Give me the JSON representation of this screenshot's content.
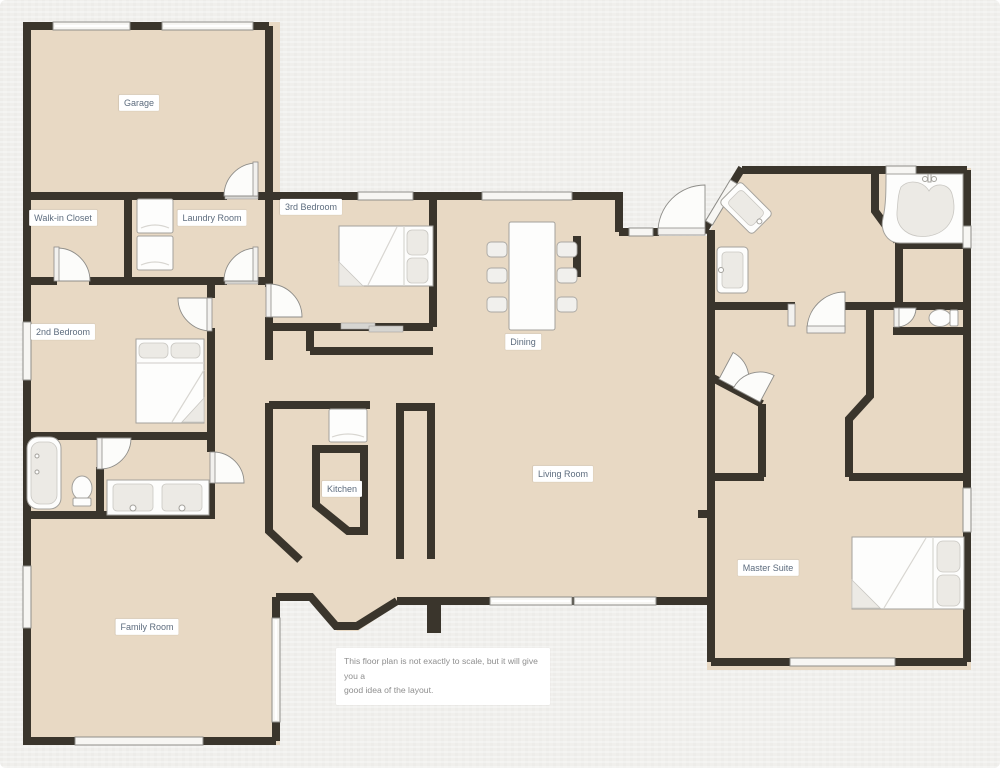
{
  "title": "House floor plan",
  "rooms": [
    {
      "id": "garage",
      "label": "Garage",
      "x": 139,
      "y": 103
    },
    {
      "id": "walk-in-closet",
      "label": "Walk-in Closet",
      "x": 63,
      "y": 218
    },
    {
      "id": "laundry-room",
      "label": "Laundry Room",
      "x": 212,
      "y": 218
    },
    {
      "id": "3rd-bedroom",
      "label": "3rd Bedroom",
      "x": 311,
      "y": 207
    },
    {
      "id": "2nd-bedroom",
      "label": "2nd Bedroom",
      "x": 63,
      "y": 332
    },
    {
      "id": "dining",
      "label": "Dining",
      "x": 523,
      "y": 342
    },
    {
      "id": "kitchen",
      "label": "Kitchen",
      "x": 342,
      "y": 489
    },
    {
      "id": "living-room",
      "label": "Living Room",
      "x": 563,
      "y": 474
    },
    {
      "id": "family-room",
      "label": "Family Room",
      "x": 147,
      "y": 627
    },
    {
      "id": "master-suite",
      "label": "Master Suite",
      "x": 768,
      "y": 568
    }
  ],
  "disclaimer": {
    "line1": "This floor plan is not exactly to scale, but it will give you a",
    "line2": "good idea of the layout."
  },
  "fixtures": [
    {
      "id": "bed-2nd-bedroom",
      "type": "double-bed"
    },
    {
      "id": "bed-3rd-bedroom",
      "type": "double-bed"
    },
    {
      "id": "bed-master",
      "type": "double-bed"
    },
    {
      "id": "bathtub",
      "type": "bathtub"
    },
    {
      "id": "corner-tub",
      "type": "corner-garden-tub"
    },
    {
      "id": "toilet-hall-bath",
      "type": "toilet"
    },
    {
      "id": "toilet-master-wc",
      "type": "toilet"
    },
    {
      "id": "double-vanity",
      "type": "two-sink-vanity"
    },
    {
      "id": "master-sink-angled",
      "type": "sink"
    },
    {
      "id": "master-sink",
      "type": "sink"
    },
    {
      "id": "washer-dryer",
      "type": "stacked-laundry-pair"
    },
    {
      "id": "refrigerator",
      "type": "refrigerator"
    },
    {
      "id": "dining-table",
      "type": "table-with-6-chairs"
    }
  ],
  "colors": {
    "background": "#f0efec",
    "floor": "#e8d9c4",
    "wall": "#3a352c",
    "window_fill": "#f7f6f3",
    "window_stroke": "#8f8e8a",
    "door_fill": "#fcfcfa",
    "door_stroke": "#8e8d89",
    "fixture_fill": "#fdfdfc",
    "fixture_stroke": "#a3a19c",
    "fixture_shade": "#eceae5",
    "threshold": "#d6d5d1",
    "label_bg": "#ffffff",
    "label_text": "#5d6c7e",
    "note_text": "#8e8e8e"
  }
}
